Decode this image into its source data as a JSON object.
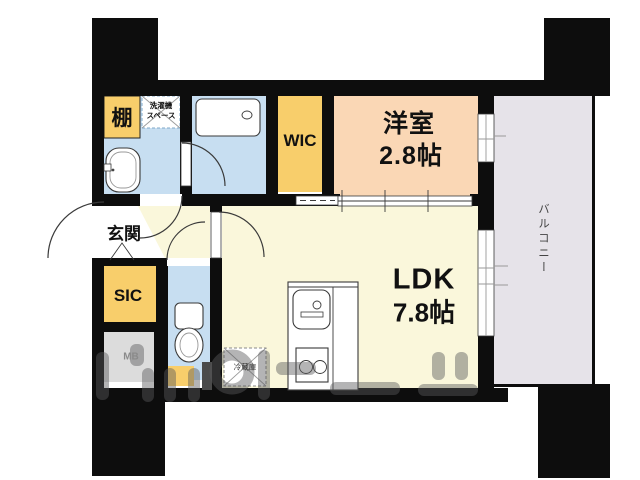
{
  "plan_title": "1LDK apartment floor plan",
  "rooms": {
    "shelf": {
      "label": "棚"
    },
    "laundry": {
      "line1": "洗濯機",
      "line2": "スペース"
    },
    "wic": {
      "label": "WIC"
    },
    "western": {
      "name": "洋室",
      "size": "2.8帖"
    },
    "balcony": {
      "label": "バルコニー"
    },
    "ldk": {
      "name": "LDK",
      "size": "7.8帖"
    },
    "entrance": {
      "label": "玄関"
    },
    "sic": {
      "label": "SIC"
    },
    "meter_box": {
      "label": "MB"
    },
    "refrigerator": {
      "label": "冷蔵庫"
    }
  },
  "colors": {
    "wall": "#0d0d0d",
    "floor_cream": "#FAF7DB",
    "floor_blue": "#C7DEF1",
    "floor_peach": "#FAD7B5",
    "closet_yellow": "#F8CE6B",
    "balcony_gray": "#E6E3E9",
    "mb_gray": "#DCDCDC",
    "watermark": "#58585A"
  }
}
